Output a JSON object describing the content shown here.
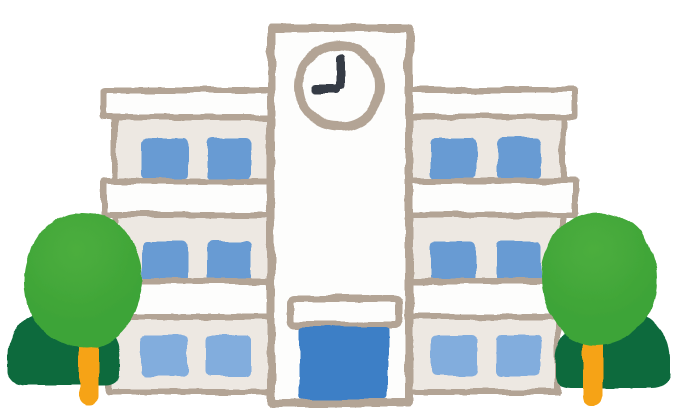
{
  "scene": {
    "subject": "school building illustration with clock tower and trees",
    "clock": {
      "time": "9:00"
    },
    "colors": {
      "outline": "#b3a495",
      "wall": "#ede8e2",
      "band": "#fdfdfc",
      "window": "#689bd3",
      "window_light": "#82addd",
      "door": "#3d7fc6",
      "hand": "#343a44",
      "canopy": "#3ea437",
      "canopy_light": "#4cae3e",
      "bush": "#0c6b3e",
      "trunk": "#f6a312"
    },
    "building": {
      "wings": 2,
      "floors_per_wing": 3,
      "windows_per_floor_per_wing": 2,
      "tower": {
        "has_clock": true,
        "has_entrance_sign": true,
        "has_entrance_door": true
      }
    },
    "trees": {
      "count": 2,
      "positions": [
        "left",
        "right"
      ]
    }
  }
}
